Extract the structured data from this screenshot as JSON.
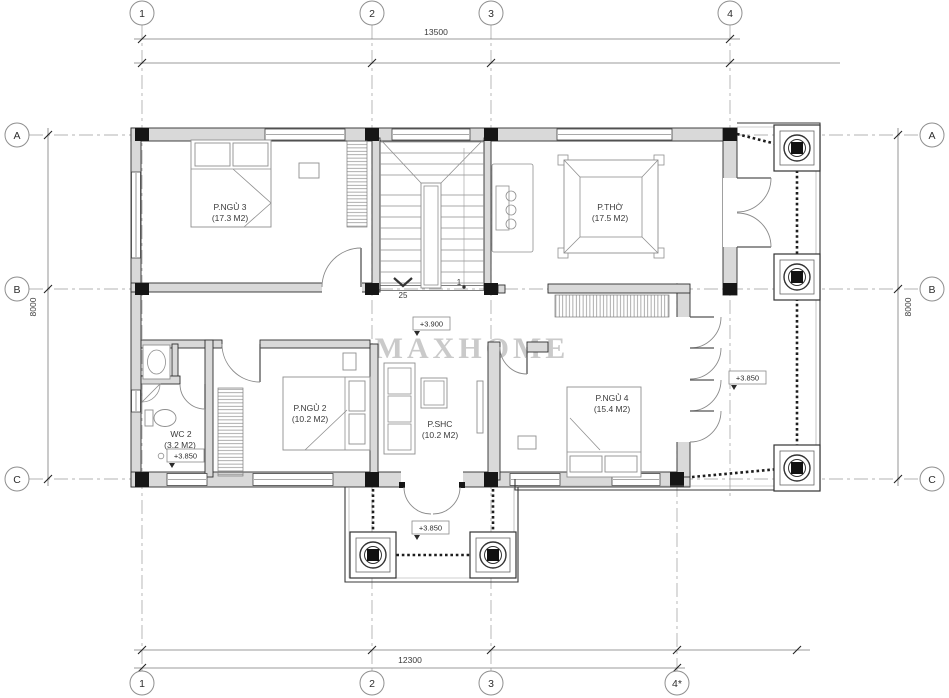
{
  "watermark": "MAXHOME",
  "grid_markers": {
    "top": [
      "1",
      "2",
      "3",
      "4"
    ],
    "bottom": [
      "1",
      "2",
      "3",
      "4*"
    ],
    "left": [
      "A",
      "B",
      "C"
    ],
    "right": [
      "A",
      "B",
      "C"
    ]
  },
  "dimensions": {
    "top": "13500",
    "bottom": "12300",
    "left": "8000",
    "right": "8000"
  },
  "rooms": [
    {
      "name": "P.NGỦ 3",
      "area": "(17.3 M2)"
    },
    {
      "name": "P.THỜ",
      "area": "(17.5 M2)"
    },
    {
      "name": "P.NGỦ 2",
      "area": "(10.2 M2)"
    },
    {
      "name": "WC 2",
      "area": "(3.2 M2)"
    },
    {
      "name": "P.SHC",
      "area": "(10.2 M2)"
    },
    {
      "name": "P.NGỦ 4",
      "area": "(15.4 M2)"
    }
  ],
  "levels": {
    "hall": "+3.900",
    "wc": "+3.850",
    "side_balcony": "+3.850",
    "front_balcony": "+3.850"
  },
  "stairs": {
    "riser_total": "25",
    "riser_start": "1"
  }
}
